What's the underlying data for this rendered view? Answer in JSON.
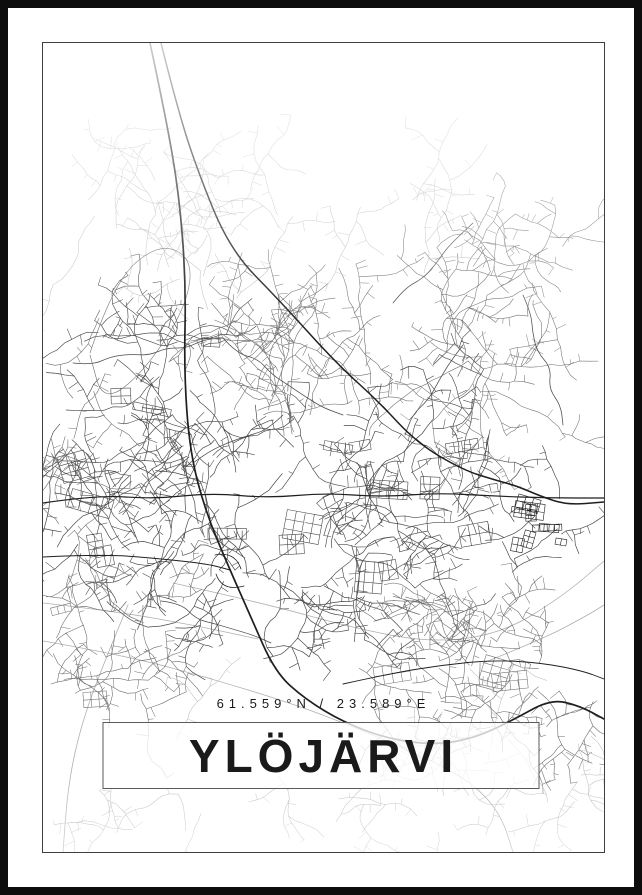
{
  "poster": {
    "title": "YLÖJÄRVI",
    "coordinates_label": "61.559°N / 23.589°E",
    "colors": {
      "frame": "#0d0d0d",
      "matte": "#ffffff",
      "map_border": "#3f3f3f",
      "title_box_border": "#5a5a5a",
      "title_box_background": "#ffffff",
      "text": "#1a1a1a",
      "road_major": "#1f1f1f",
      "road_medium": "#4a4a4a",
      "road_minor": "#6f6f6f",
      "road_faint": "#bdbdbd",
      "water_line": "#afafaf"
    }
  }
}
